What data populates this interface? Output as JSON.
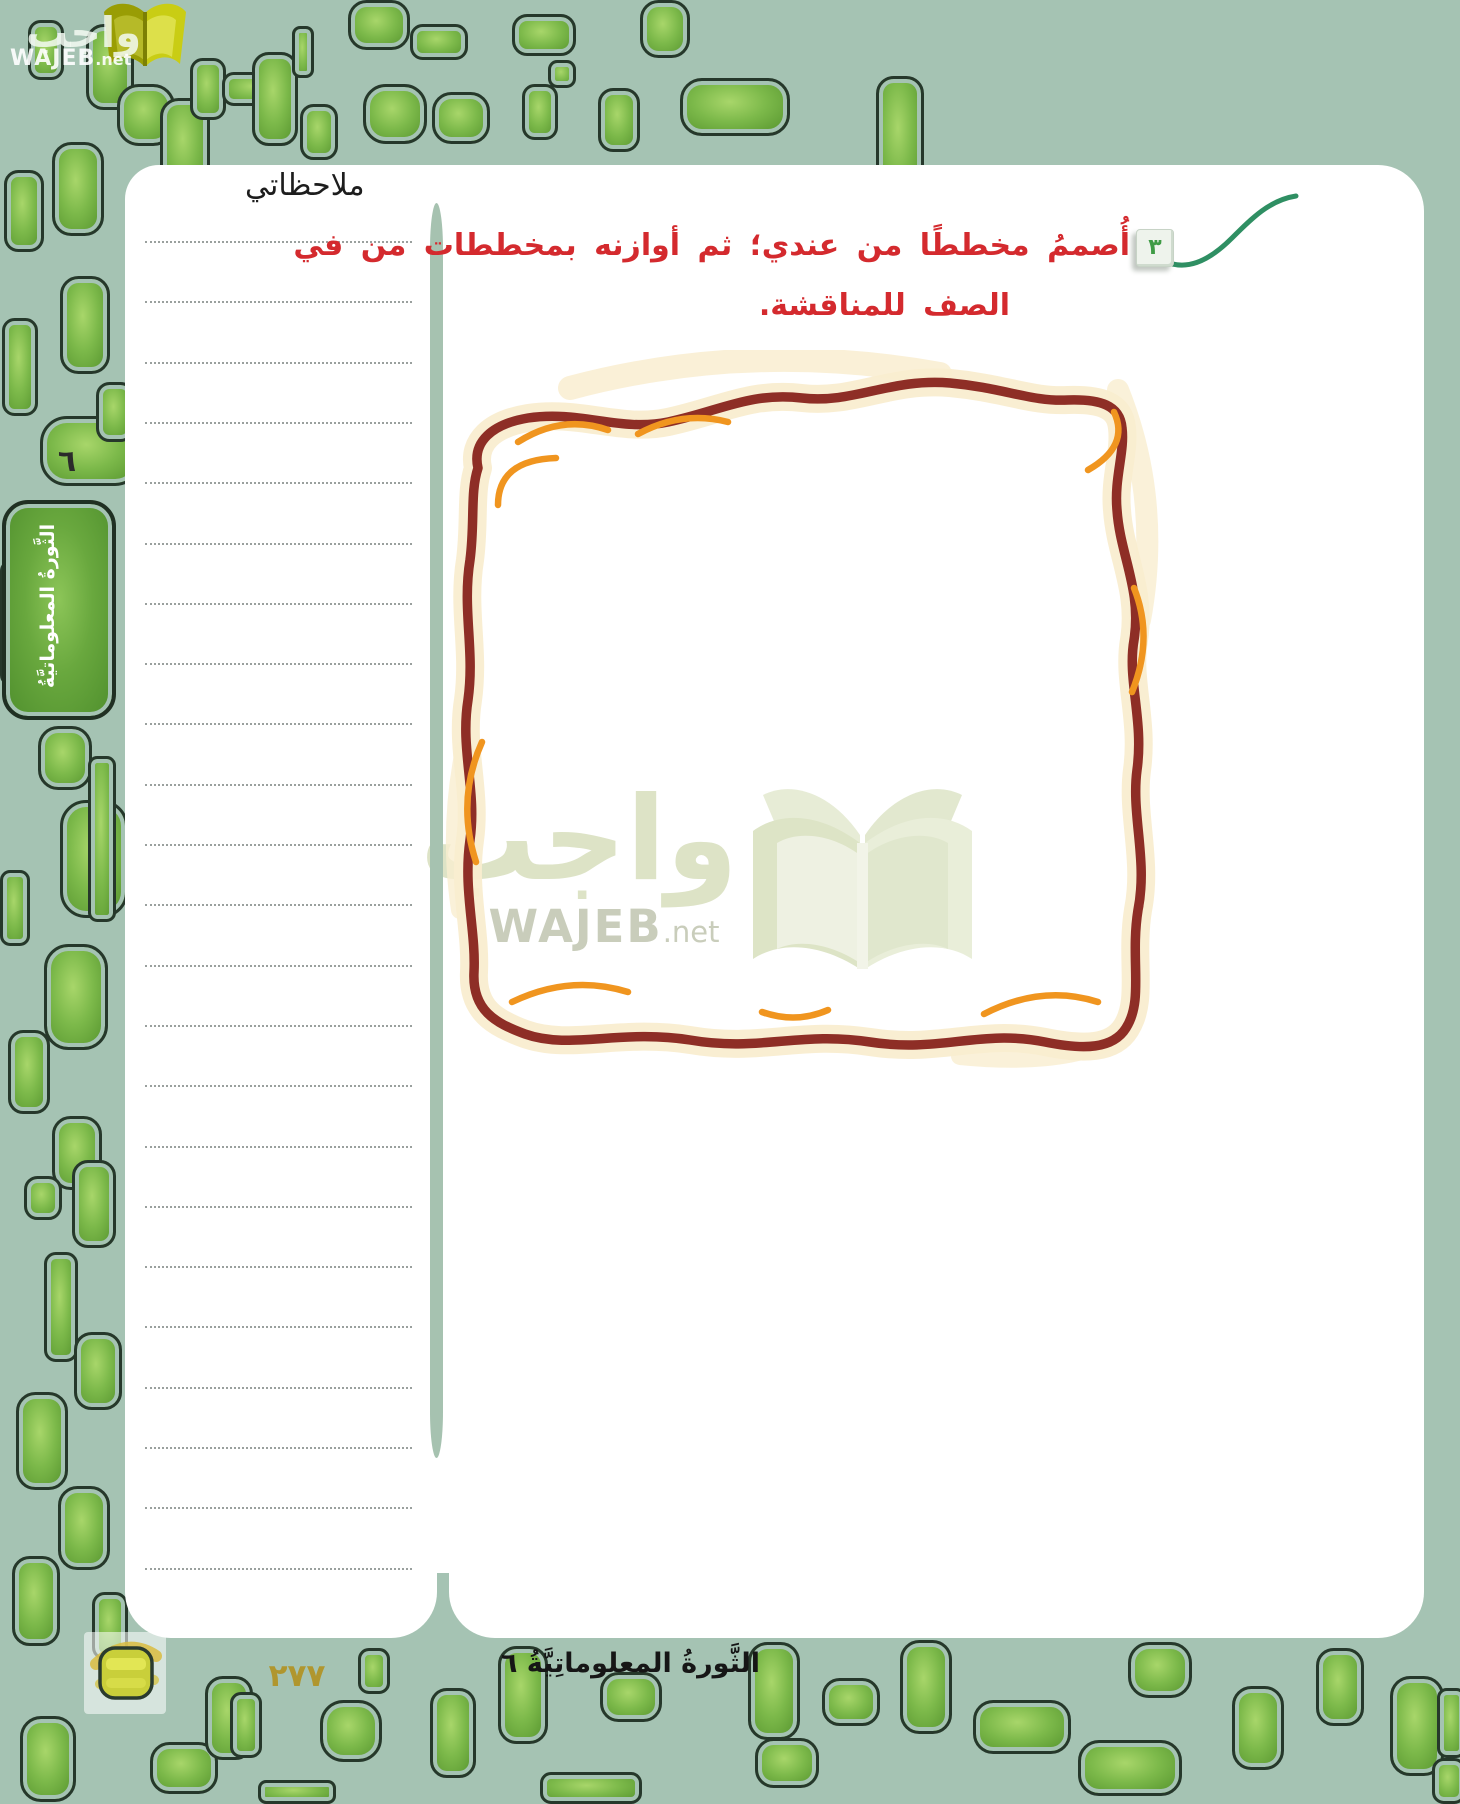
{
  "page": {
    "badge_number": "٣",
    "instruction_line1": "أُصممُ مخططًا من عندي؛ ثم أوازنه بمخططات من في",
    "instruction_line2": "الصف للمناقشة.",
    "notes_header": "ملاحظاتي",
    "sidebar_unit_number": "٦",
    "sidebar_tab_label": "الثَّورةُ المعلوماتيَّةُ",
    "footer_title": "الثَّورةُ المعلوماتِيَّةُ ٦",
    "page_number": "٢٧٧"
  },
  "logo_top_left": {
    "arabic": "واجب",
    "latin_bold": "WAJEB",
    "latin_suffix": ".net"
  },
  "watermark": {
    "arabic": "واجب",
    "latin_bold": "WAJEB",
    "latin_suffix": ".net"
  },
  "colors": {
    "background_sage": "#a5c3b3",
    "accent_red": "#d42a2e",
    "frame_maroon": "#8e2e26",
    "frame_orange": "#f0951f",
    "frame_glow": "#f9edd0",
    "pill_green": "#6aa73c",
    "pill_outline": "#26382b",
    "swoosh_green": "#2f8f63",
    "page_number_gold": "#b0962e",
    "tab_green": "#5d9b36",
    "badge_number_green": "#3f9b45",
    "watermark_olive": "#dde3c6"
  }
}
